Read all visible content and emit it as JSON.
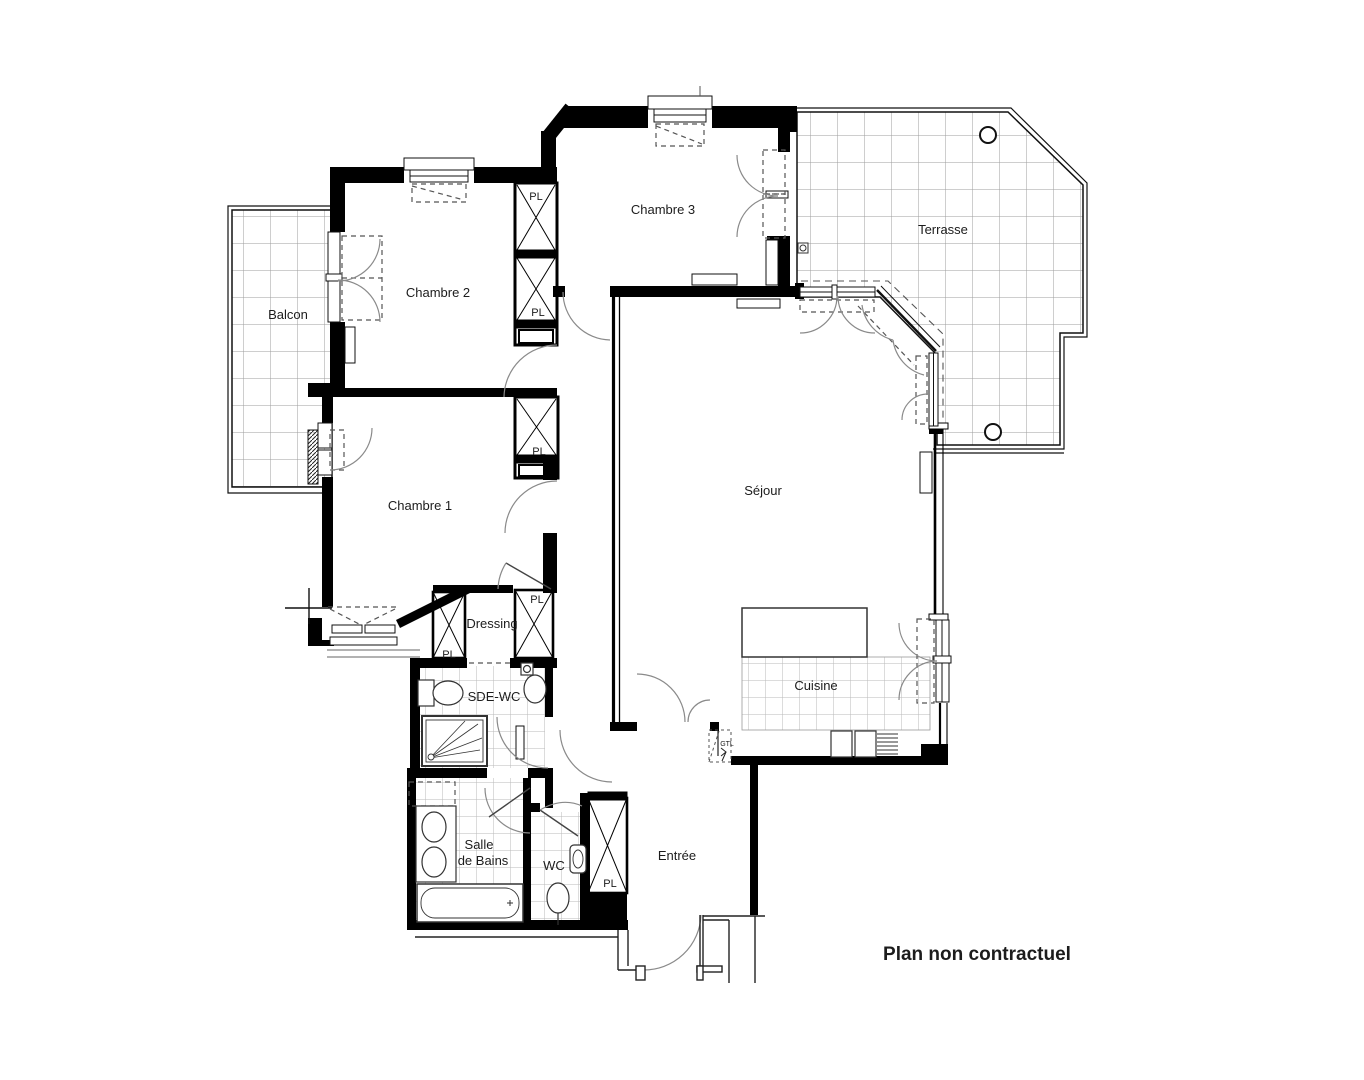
{
  "plan": {
    "disclaimer": "Plan non contractuel",
    "rooms": {
      "balcon": "Balcon",
      "chambre1": "Chambre 1",
      "chambre2": "Chambre 2",
      "chambre3": "Chambre 3",
      "terrasse": "Terrasse",
      "sejour": "Séjour",
      "dressing": "Dressing",
      "sde_wc": "SDE-WC",
      "cuisine": "Cuisine",
      "salle_de_bains_line1": "Salle",
      "salle_de_bains_line2": "de Bains",
      "wc": "WC",
      "entree": "Entrée"
    },
    "closet_label": "PL",
    "gtl_label": "GTL",
    "colors": {
      "wall": "#000000",
      "tile_grid_large": "#9e9e9e",
      "tile_grid_small": "#bababa",
      "door_arc": "#8a8a8a",
      "dashed_line": "#555555"
    }
  }
}
